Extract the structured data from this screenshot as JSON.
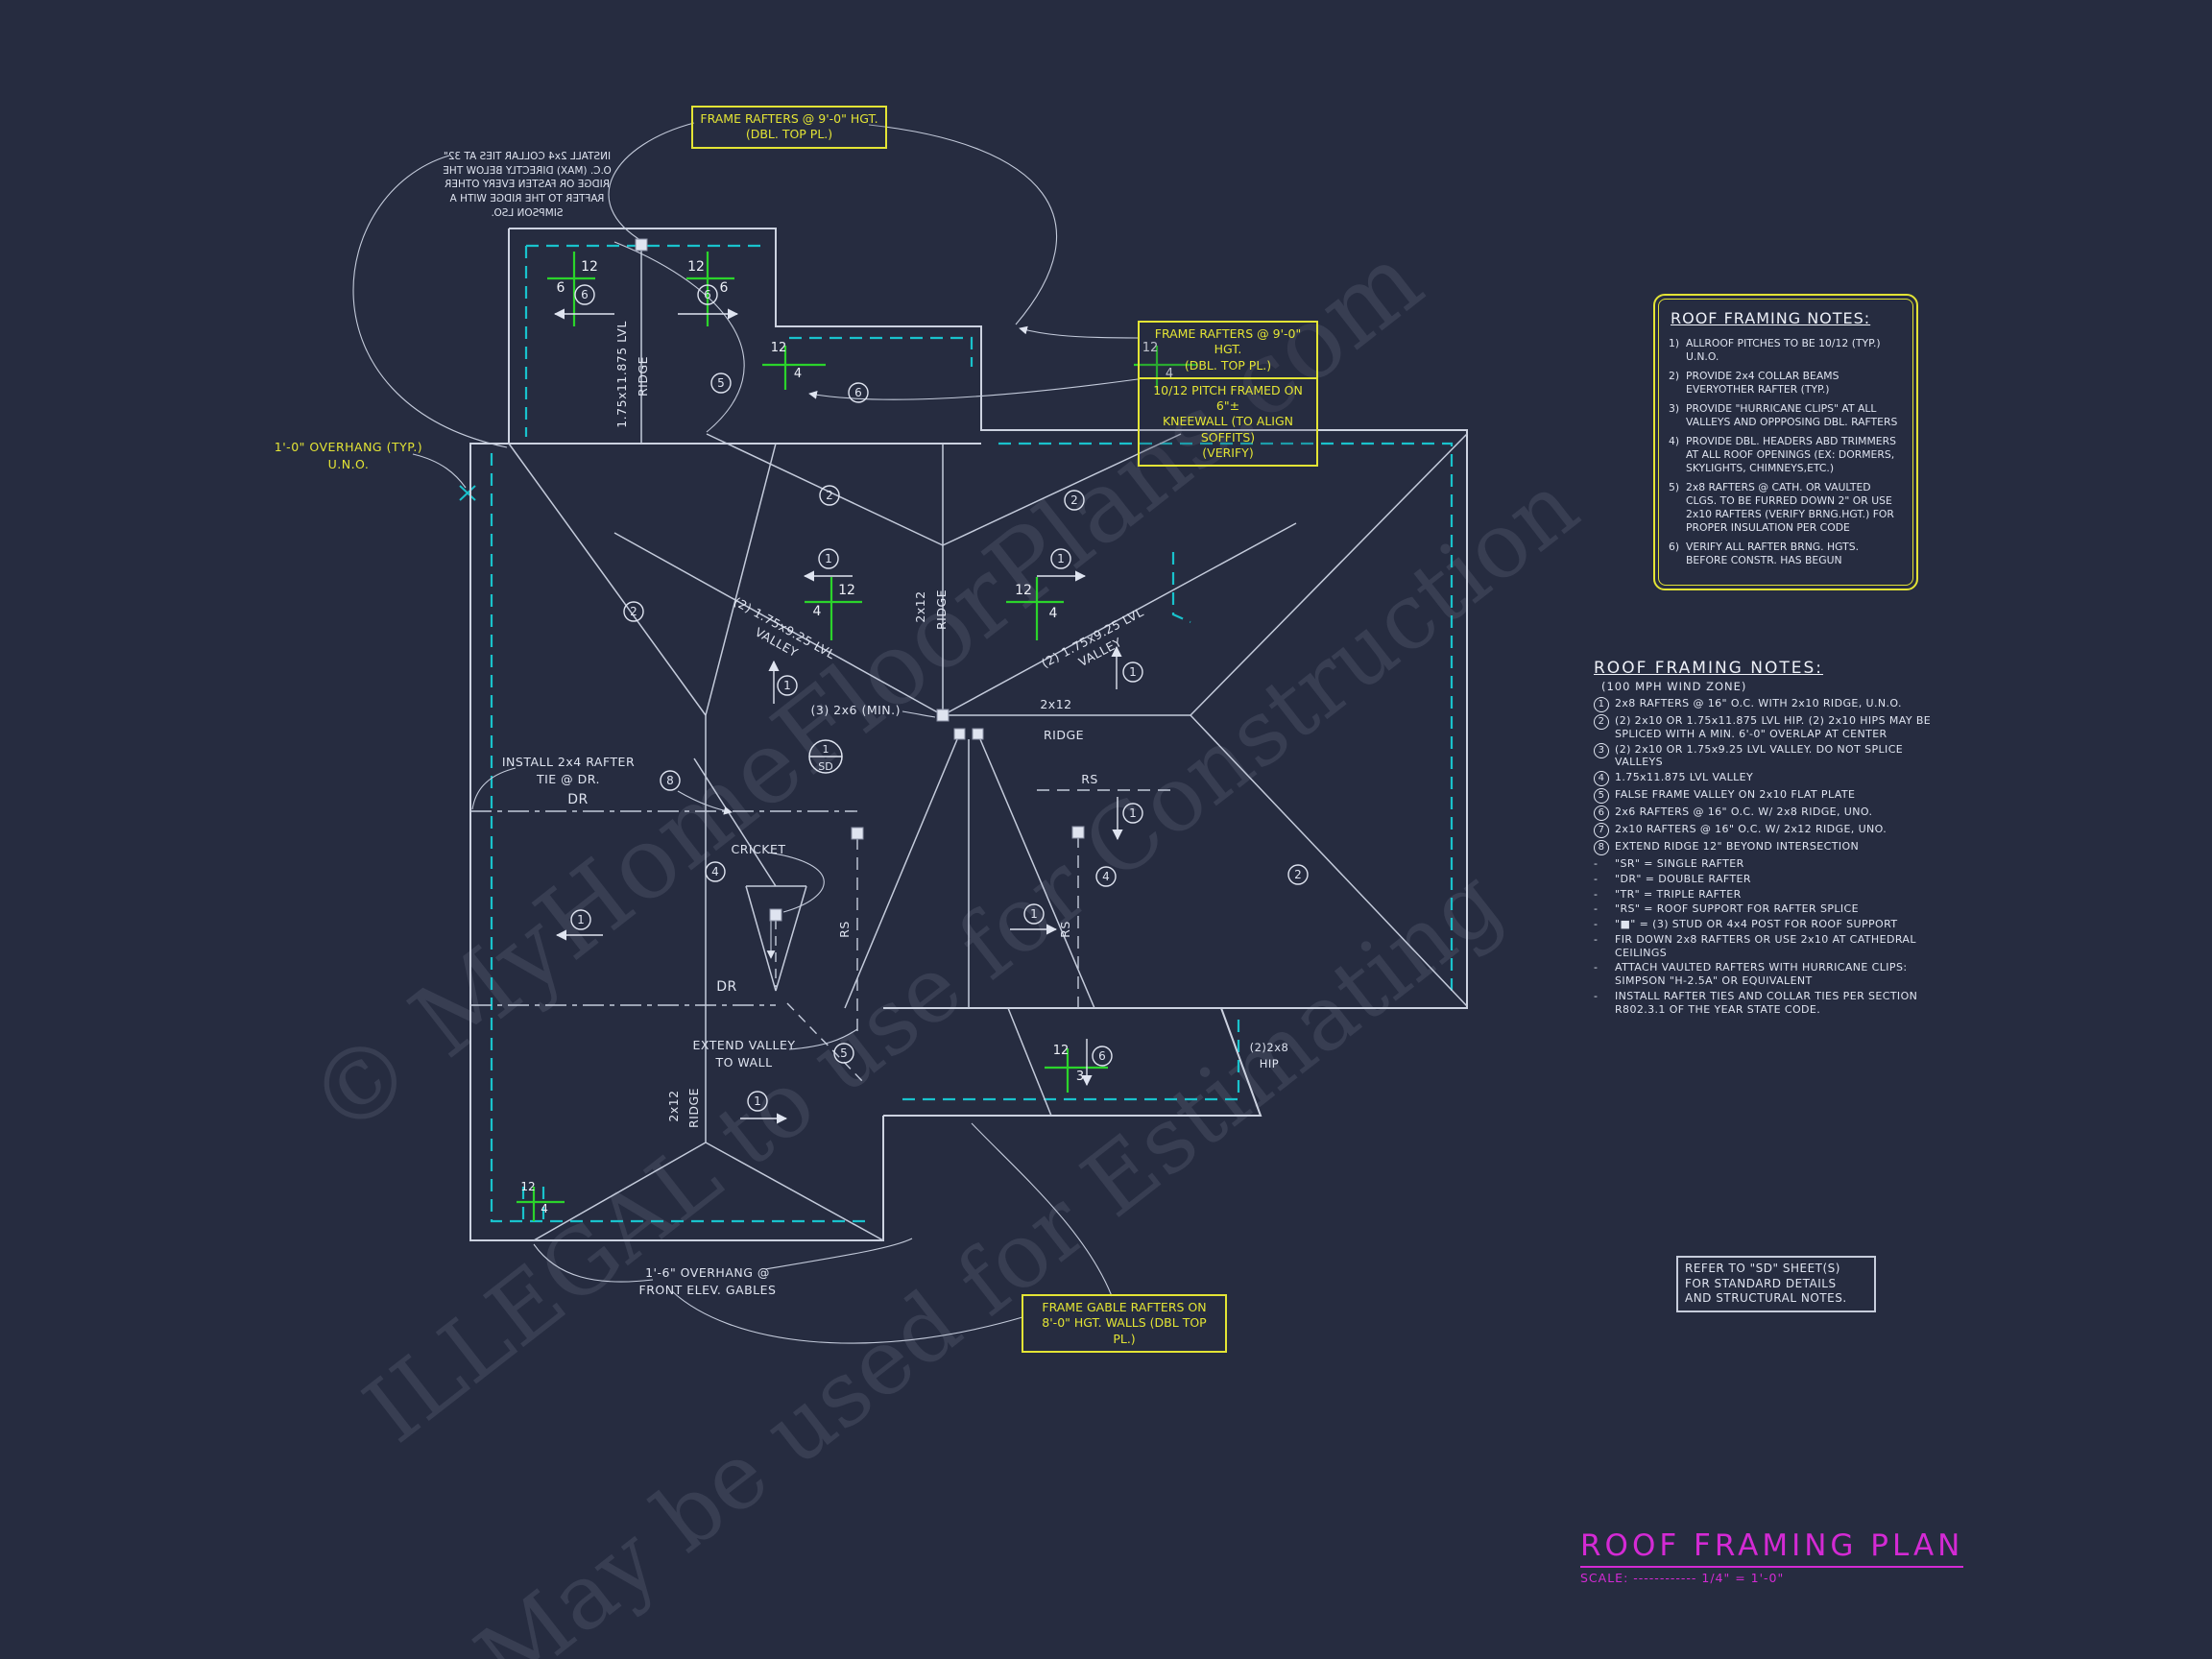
{
  "colors": {
    "background": "#262c40",
    "line": "#ccd2e0",
    "cyan": "#19c2cc",
    "yellow": "#e3e435",
    "green": "#2bd42b",
    "magenta": "#d42ad4"
  },
  "watermarks": {
    "line1": "© MyHomeFloorPlans.com",
    "line2": "ILLEGAL to use for Construction",
    "line3": "May be used for Estimating"
  },
  "title_block": {
    "title": "ROOF FRAMING PLAN",
    "scale": "SCALE: ------------ 1/4\" = 1'-0\""
  },
  "refer_note": {
    "line1": "REFER TO \"SD\" SHEET(S)",
    "line2": "FOR STANDARD DETAILS",
    "line3": "AND STRUCTURAL NOTES."
  },
  "notes_box": {
    "heading": "ROOF FRAMING NOTES:",
    "items": [
      {
        "n": "1)",
        "t": "ALLROOF PITCHES TO BE 10/12 (TYP.) U.N.O."
      },
      {
        "n": "2)",
        "t": "PROVIDE 2x4 COLLAR BEAMS EVERYOTHER RAFTER (TYP.)"
      },
      {
        "n": "3)",
        "t": "PROVIDE \"HURRICANE CLIPS\" AT ALL VALLEYS AND OPPPOSING DBL. RAFTERS"
      },
      {
        "n": "4)",
        "t": "PROVIDE DBL. HEADERS ABD TRIMMERS AT ALL ROOF OPENINGS (EX: DORMERS, SKYLIGHTS, CHIMNEYS,ETC.)"
      },
      {
        "n": "5)",
        "t": "2x8 RAFTERS @ CATH. OR VAULTED CLGS. TO BE FURRED DOWN 2\" OR USE 2x10 RAFTERS (VERIFY BRNG.HGT.) FOR PROPER INSULATION PER CODE"
      },
      {
        "n": "6)",
        "t": "VERIFY ALL RAFTER BRNG. HGTS. BEFORE CONSTR. HAS BEGUN"
      }
    ]
  },
  "framing_notes": {
    "heading": "ROOF FRAMING NOTES:",
    "subheading": "(100 MPH WIND ZONE)",
    "items": [
      {
        "n": "1",
        "t": "2x8 RAFTERS @ 16\" O.C. WITH 2x10 RIDGE, U.N.O."
      },
      {
        "n": "2",
        "t": "(2) 2x10 OR 1.75x11.875 LVL HIP. (2) 2x10 HIPS MAY BE SPLICED WITH A MIN. 6'-0\" OVERLAP AT CENTER"
      },
      {
        "n": "3",
        "t": "(2) 2x10 OR 1.75x9.25 LVL VALLEY. DO NOT SPLICE VALLEYS"
      },
      {
        "n": "4",
        "t": "1.75x11.875 LVL VALLEY"
      },
      {
        "n": "5",
        "t": "FALSE FRAME VALLEY ON 2x10 FLAT PLATE"
      },
      {
        "n": "6",
        "t": "2x6 RAFTERS @ 16\" O.C. W/ 2x8 RIDGE, UNO."
      },
      {
        "n": "7",
        "t": "2x10 RAFTERS @ 16\" O.C. W/ 2x12 RIDGE, UNO."
      },
      {
        "n": "8",
        "t": "EXTEND RIDGE 12\" BEYOND INTERSECTION"
      },
      {
        "n": "-",
        "t": "\"SR\" = SINGLE RAFTER"
      },
      {
        "n": "-",
        "t": "\"DR\" = DOUBLE RAFTER"
      },
      {
        "n": "-",
        "t": "\"TR\" = TRIPLE RAFTER"
      },
      {
        "n": "-",
        "t": "\"RS\" = ROOF SUPPORT FOR RAFTER SPLICE"
      },
      {
        "n": "-",
        "t": "\"■\" = (3) STUD OR 4x4 POST FOR ROOF SUPPORT"
      },
      {
        "n": "-",
        "t": "FIR DOWN 2x8 RAFTERS OR USE 2x10 AT CATHEDRAL CEILINGS"
      },
      {
        "n": "-",
        "t": "ATTACH VAULTED RAFTERS WITH HURRICANE CLIPS: SIMPSON \"H-2.5A\" OR EQUIVALENT"
      },
      {
        "n": "-",
        "t": "INSTALL RAFTER TIES AND COLLAR TIES PER SECTION R802.3.1 OF THE YEAR STATE CODE."
      }
    ]
  },
  "callouts": {
    "top_box": [
      "FRAME RAFTERS @ 9'-0\" HGT.",
      "(DBL. TOP PL.)"
    ],
    "mid_box1": [
      "FRAME RAFTERS @ 9'-0\" HGT.",
      "(DBL. TOP PL.)"
    ],
    "mid_box2": [
      "10/12 PITCH FRAMED ON 6\"±",
      "KNEEWALL (TO ALIGN SOFFITS)",
      "(VERIFY)"
    ],
    "bottom_box": [
      "FRAME GABLE RAFTERS ON",
      "8'-0\" HGT. WALLS (DBL TOP PL.)"
    ]
  },
  "plan": {
    "collar_note": [
      "INSTALL 2x4 COLLAR TIES AT 32\"",
      "O.C. (MAX) DIRECTLY BELOW THE",
      "RIDGE OR FASTEN EVERY OTHER",
      "RAFTER TO THE RIDGE WITH A",
      "SIMPSON LSO."
    ],
    "overhang_left": [
      "1'-0\" OVERHANG (TYP.)",
      "U.N.O."
    ],
    "rafter_tie": [
      "INSTALL 2x4 RAFTER",
      "TIE @ DR."
    ],
    "cricket": "CRICKET",
    "extend_valley": [
      "EXTEND VALLEY",
      "TO WALL"
    ],
    "overhang_front": [
      "1'-6\" OVERHANG @",
      "FRONT ELEV. GABLES"
    ],
    "hip": [
      "(2)2x8",
      "HIP"
    ],
    "min_rafters": "(3) 2x6 (MIN.)",
    "valley_lvl": [
      "(2) 1.75x9.25 LVL",
      "VALLEY"
    ],
    "ridge_2x12": [
      "2x12",
      "RIDGE"
    ],
    "ridge_lvl": [
      "1.75x11.875 LVL",
      "RIDGE"
    ],
    "rs": "RS",
    "dr": "DR",
    "sd_detail": [
      "1",
      "SD"
    ]
  },
  "bubbles": {
    "n1": "1",
    "n2": "2",
    "n4": "4",
    "n5": "5",
    "n6": "6",
    "n8": "8"
  },
  "pitch": {
    "run": "12",
    "rise6": "6",
    "rise4": "4",
    "rise3": "3"
  }
}
